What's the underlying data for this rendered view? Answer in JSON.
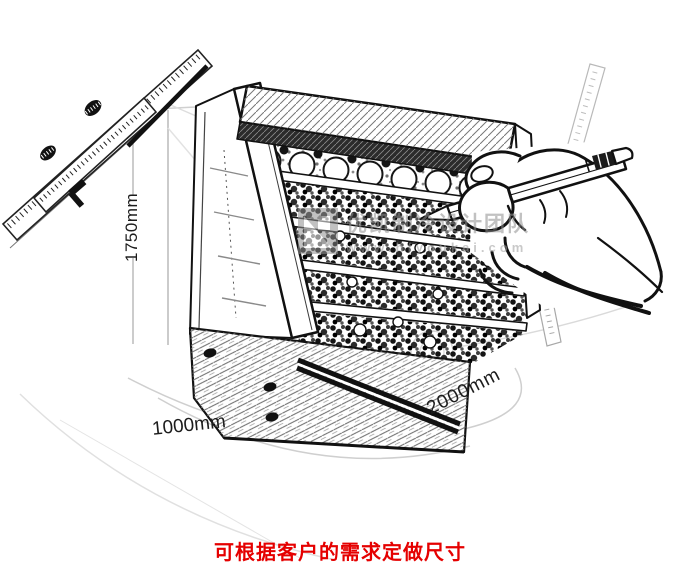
{
  "page": {
    "background": "#ffffff"
  },
  "dimensions": {
    "height": "1750mm",
    "depth": "1000mm",
    "length": "2000mm"
  },
  "caption": {
    "text": "可根据客户的需求定做尺寸",
    "color": "#e50000"
  },
  "watermark": {
    "title": "优凯制冷设计团队",
    "url": "www.hfyoukai.com",
    "color": "#8f8f8f"
  },
  "illustration": {
    "subject": "open-front refrigerated display cooler sketch with produce shelves",
    "items": [
      "vernier-caliper",
      "display-cooler",
      "hand-holding-pencil",
      "steel-ruler",
      "tape-measure"
    ]
  }
}
